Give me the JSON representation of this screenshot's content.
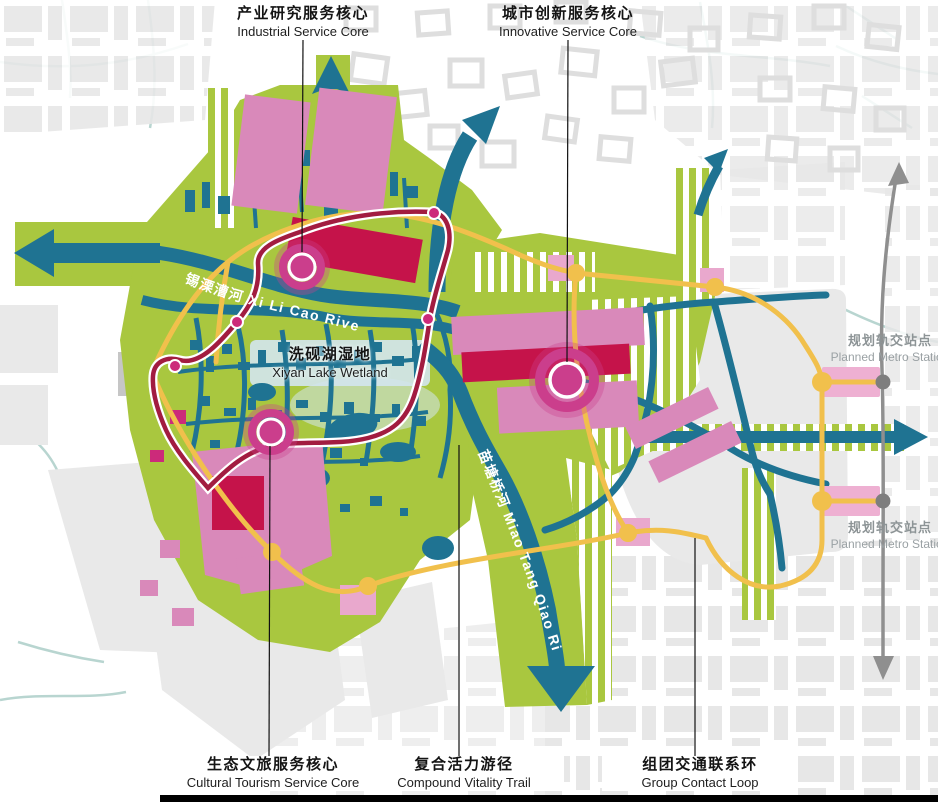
{
  "annotations": {
    "industrial_core": {
      "zh": "产业研究服务核心",
      "en": "Industrial Service Core"
    },
    "innovative_core": {
      "zh": "城市创新服务核心",
      "en": "Innovative Service Core"
    },
    "cultural_core": {
      "zh": "生态文旅服务核心",
      "en": "Cultural Tourism Service Core"
    },
    "vitality_trail": {
      "zh": "复合活力游径",
      "en": "Compound Vitality Trail"
    },
    "contact_loop": {
      "zh": "组团交通联系环",
      "en": "Group Contact Loop"
    },
    "wetland": {
      "zh": "洗砚湖湿地",
      "en": "Xiyan Lake Wetland"
    }
  },
  "rivers": {
    "xilicao": "锡溧漕河 Xi Li Cao River",
    "miaotangqiao": "苗塘桥河 Miao Tang Qiao River"
  },
  "metro": {
    "upper": {
      "zh": "规划轨交站点",
      "en": "Planned Metro Station"
    },
    "lower": {
      "zh": "规划轨交站点",
      "en": "Planned Metro Station"
    }
  },
  "colors": {
    "greenspace": "#a9c73f",
    "water_teal": "#1f7392",
    "canal_pale": "#b8d5d0",
    "city_gray": "#e7e7e7",
    "pink_block": "#d989ba",
    "deep_pink": "#cb3e8c",
    "crimson_block": "#c5134a",
    "trail_red": "#a21c40",
    "loop_yellow": "#f1c04c",
    "metro_gray": "#8f8f8f",
    "station_pink": "#eeb0d2",
    "lake_blue": "#d3e6ee",
    "label_black": "#141414",
    "metro_label_gray": "#8d9496"
  }
}
